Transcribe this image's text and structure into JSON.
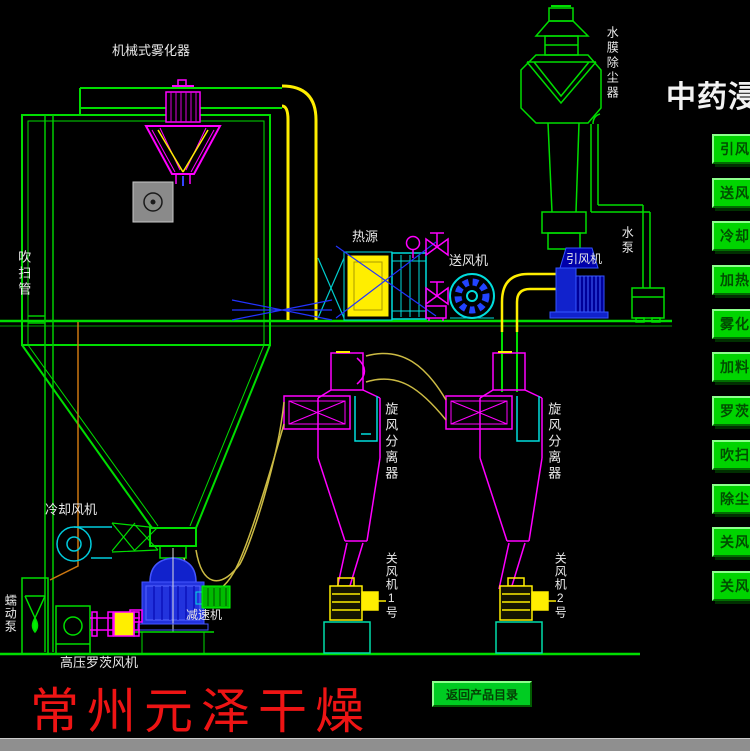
{
  "title": "中药浸膏",
  "brand": "常州元泽干燥",
  "back_button": "返回产品目录",
  "sidebar": {
    "buttons": [
      "引风",
      "送风",
      "冷却",
      "加热",
      "雾化",
      "加料",
      "罗茨",
      "吹扫",
      "除尘",
      "关风",
      "关风"
    ]
  },
  "labels": {
    "atomizer": "机械式雾化器",
    "scrubber": "水膜除尘器",
    "purge_pipe": "吹扫管",
    "heat_source": "热源",
    "supply_fan": "送风机",
    "induced_fan": "引风机",
    "water_pump": "水泵",
    "cyclone1": "旋风分离器",
    "cyclone2": "旋风分离器",
    "cooling_fan": "冷却风机",
    "reducer": "减速机",
    "roots_blower": "高压罗茨风机",
    "peristaltic_pump": "蠕动泵",
    "rotary_valve1": "关风机1号",
    "rotary_valve2": "关风机2号"
  },
  "colors": {
    "background": "#000000",
    "line_green": "#00dd00",
    "line_magenta": "#ff00ff",
    "line_yellow": "#ffee00",
    "line_cyan": "#00dddd",
    "line_blue": "#2233dd",
    "pipe_dark_yellow": "#ccbb44",
    "feed_orange": "#cc7711",
    "brand_red": "#ee1414",
    "button_green": "#00d400",
    "label_white": "#e9e9e9"
  }
}
